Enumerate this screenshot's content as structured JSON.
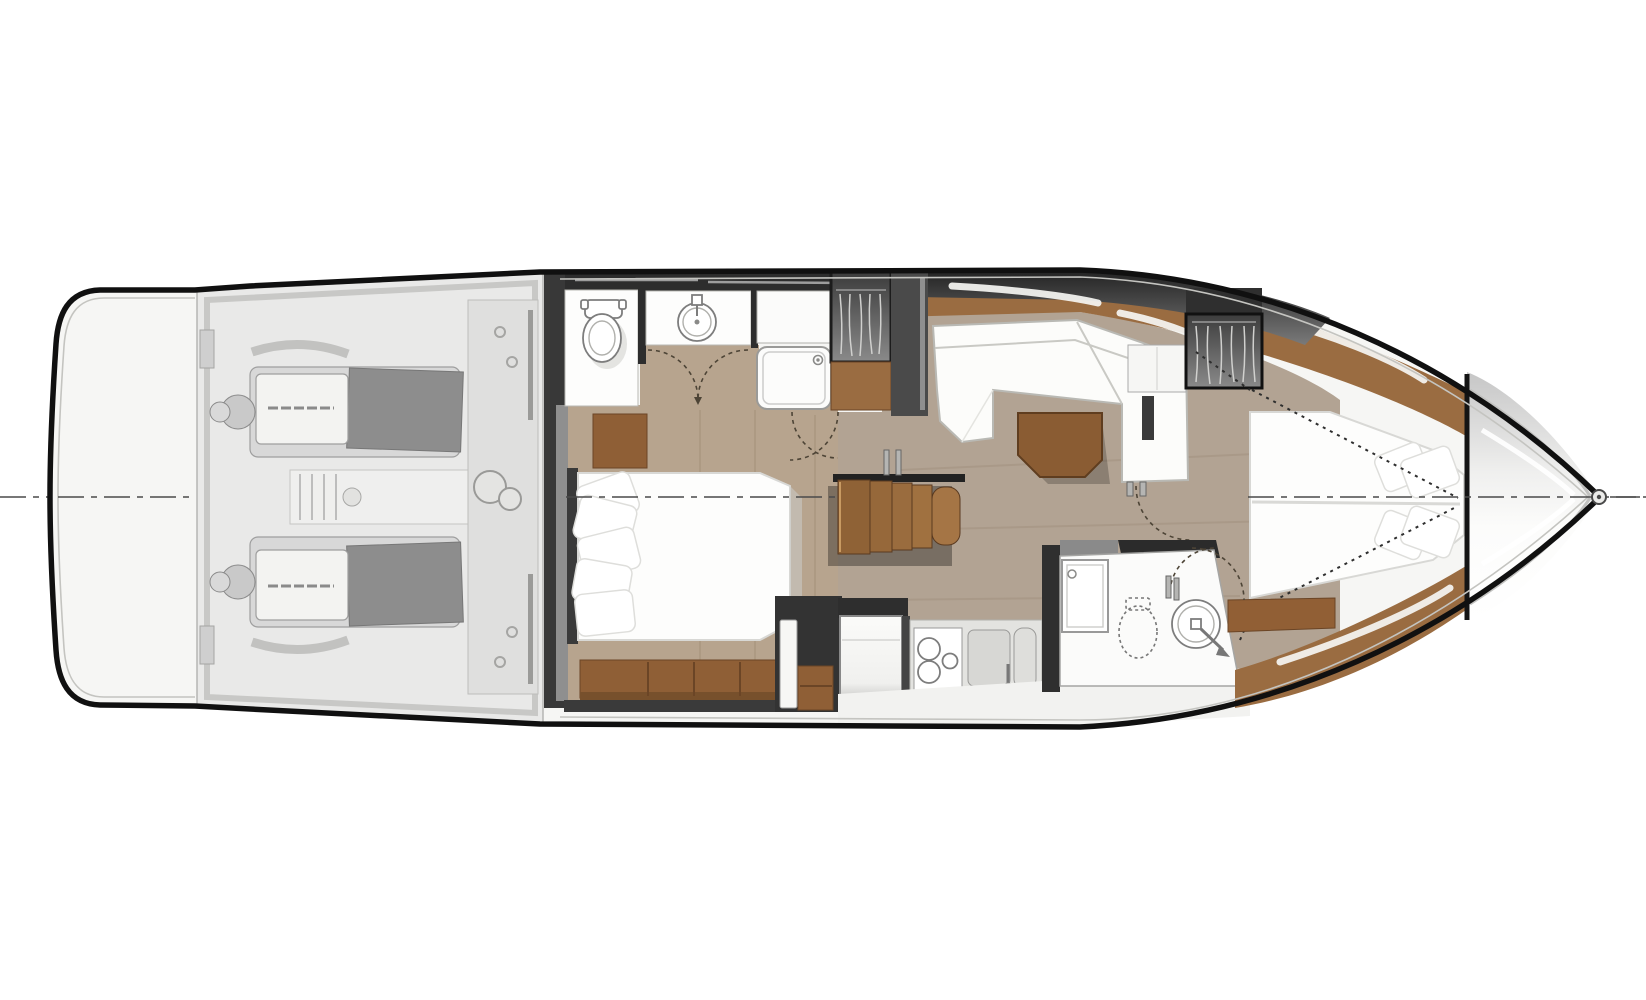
{
  "diagram": {
    "label": "Motor yacht lower-deck interior floor plan, overhead view, bow pointing right",
    "view": "top-down plan",
    "centerline_style": "dash-dot horizontal centerline"
  },
  "palette": {
    "hull_outline": "#101010",
    "interior_bg": "#f6f6f4",
    "wall_dark": "#2d2d2d",
    "wall_mid": "#4a4a4a",
    "glass_band_dark": "#2a2a2a",
    "teak_deck": "#9a6c41",
    "wood_trim": "#8a5c33",
    "wood_trim_dark": "#6b4526",
    "floor_master": "#b7a48e",
    "floor_salon": "#b2a393",
    "furniture_white": "#fcfcfa",
    "engine_light": "#d8d8d8",
    "engine_dark": "#8d8d8d",
    "fixture_outline": "#7d7d7d"
  },
  "regions": {
    "swim_platform": {
      "label": "swim platform (stern)"
    },
    "engine_room": {
      "label": "engine room",
      "engines": 2
    },
    "master_bathroom": {
      "label": "aft bathroom",
      "features": [
        "toilet",
        "round sink vanity",
        "shower cabin",
        "double door",
        "hanging wardrobe"
      ]
    },
    "master_cabin": {
      "label": "midship master cabin",
      "features": [
        "double bed",
        "pillows",
        "nightstand",
        "foot bench"
      ],
      "pillows": 5
    },
    "staircase": {
      "label": "companionway stairs",
      "steps": 5
    },
    "salon": {
      "label": "salon",
      "features": [
        "L-shaped settee",
        "wood coffee table"
      ]
    },
    "galley": {
      "label": "galley",
      "features": [
        "refrigerator",
        "cooktop",
        "double sink"
      ],
      "stove_burners": 3
    },
    "guest_head": {
      "label": "guest head",
      "features": [
        "shower",
        "toilet",
        "round sink",
        "door"
      ]
    },
    "forward_cabin": {
      "label": "forward VIP cabin",
      "features": [
        "V-berth bed",
        "pillows",
        "hanging wardrobe",
        "dresser"
      ],
      "pillows": 4
    },
    "bow_deck": {
      "label": "foredeck / bow",
      "features": [
        "anchor fitting"
      ]
    },
    "centerline": {
      "label": "hull centerline"
    }
  }
}
